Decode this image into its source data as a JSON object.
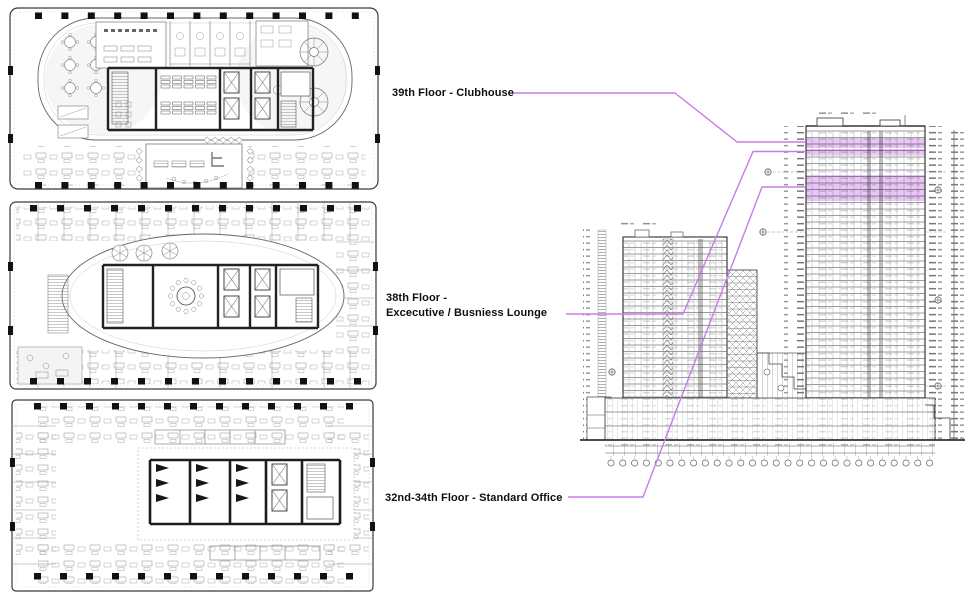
{
  "canvas": {
    "width": 969,
    "height": 599,
    "background": "#ffffff"
  },
  "labels": {
    "clubhouse": {
      "text": "39th Floor - Clubhouse"
    },
    "lounge": {
      "line1": "38th Floor -",
      "line2": "Excecutive / Busniess Lounge"
    },
    "office": {
      "text": "32nd-34th Floor - Standard Office"
    }
  },
  "colors": {
    "connector": "#c87be8",
    "highlight": "#c878e6",
    "linework": "#2a2a2a",
    "label_text": "#0e0e0e"
  },
  "elevation": {
    "highlighted_floors": [
      "39th Floor",
      "38th Floor",
      "32nd-34th Floor"
    ]
  }
}
